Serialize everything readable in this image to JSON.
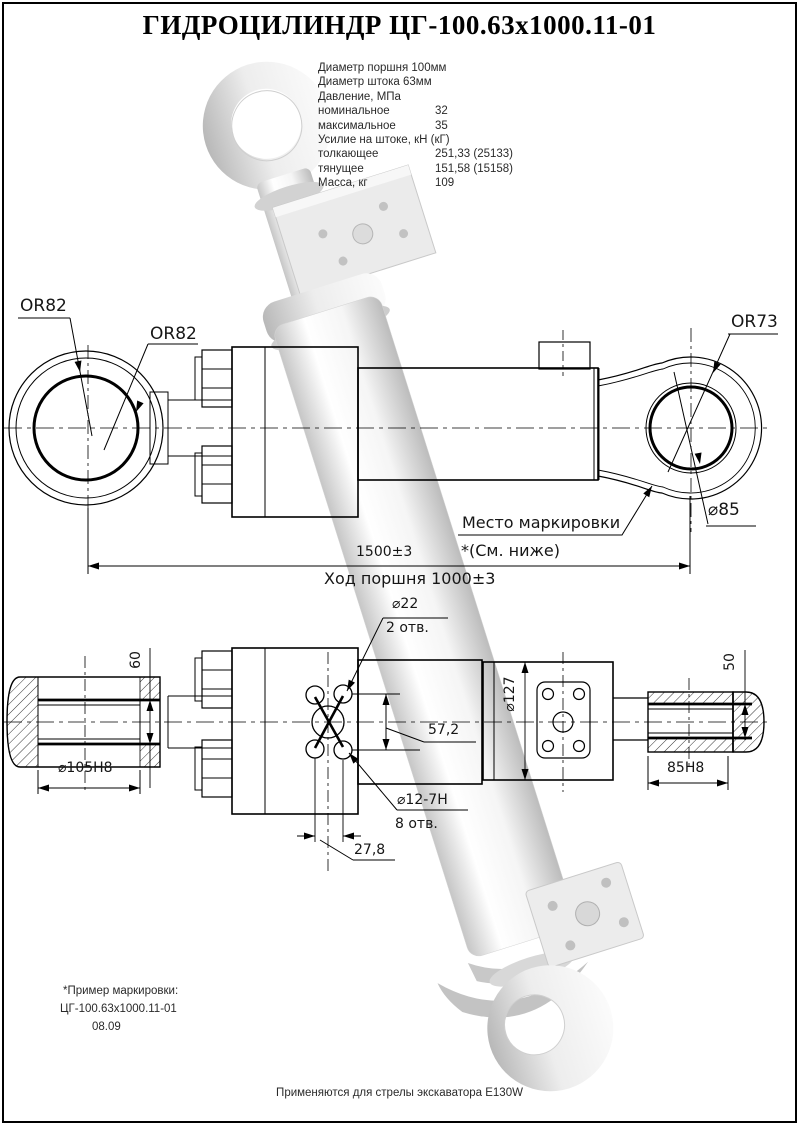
{
  "page": {
    "title": "ГИДРОЦИЛИНДР ЦГ-100.63х1000.11-01",
    "footer": "Применяются для стрелы экскаватора E130W"
  },
  "specs": {
    "rows": [
      {
        "label": "Диаметр поршня 100мм",
        "value": ""
      },
      {
        "label": "Диаметр штока 63мм",
        "value": ""
      },
      {
        "label": "Давление, МПа",
        "value": ""
      },
      {
        "label": "номинальное",
        "value": "32"
      },
      {
        "label": "максимальное",
        "value": "35"
      },
      {
        "label": "Усилие на штоке, кН (кГ)",
        "value": ""
      },
      {
        "label": "толкающее",
        "value": "251,33 (25133)"
      },
      {
        "label": "тянущее",
        "value": "151,58 (15158)"
      },
      {
        "label": "Масса, кг",
        "value": "109"
      }
    ]
  },
  "side_view": {
    "r_left_outer": "OR82",
    "r_left_inner": "OR82",
    "r_right": "OR73",
    "bore_right": "⌀85",
    "marking_place": "Место маркировки",
    "marking_note": "*(См. ниже)",
    "length_total": "1500±3",
    "stroke": "Ход поршня 1000±3"
  },
  "section_view": {
    "bore_left": "⌀105H8",
    "height_left": "60",
    "port_dia": "⌀22",
    "port_count": "2 отв.",
    "spacing_v": "57,2",
    "hole_dia": "⌀12-7H",
    "hole_count": "8 отв.",
    "spacing_h": "27,8",
    "flange_dia": "⌀127",
    "bore_right": "85H8",
    "height_right": "50"
  },
  "marking_example": {
    "line1": "*Пример маркировки:",
    "line2": "ЦГ-100.63х1000.11-01",
    "line3": "08.09"
  }
}
